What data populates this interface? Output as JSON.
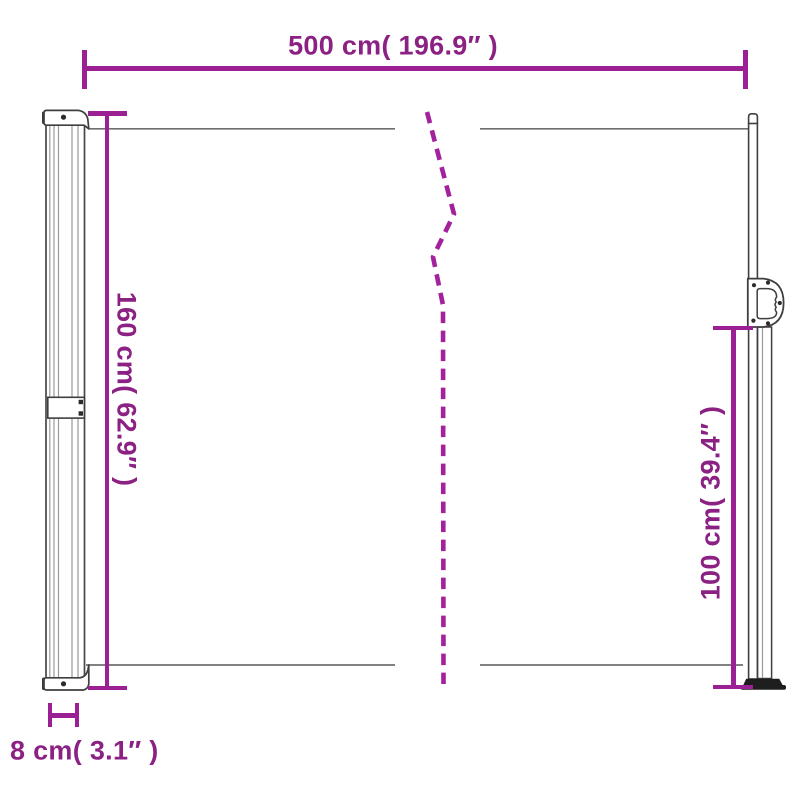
{
  "diagram": {
    "colors": {
      "dimension_line": "#9b2093",
      "dimension_text": "#8c2184",
      "break_line": "#a3219c",
      "outline": "#3f3f3f",
      "fabric_line": "#6f6f6f",
      "background": "#ffffff"
    },
    "dimensions": {
      "total_width": {
        "label": "500 cm( 196.9″ )",
        "value_cm": 500,
        "value_inch": 196.9
      },
      "left_height": {
        "label": "160 cm( 62.9″ )",
        "value_cm": 160,
        "value_inch": 62.9
      },
      "right_height": {
        "label": "100 cm( 39.4″ )",
        "value_cm": 100,
        "value_inch": 39.4
      },
      "post_depth": {
        "label": "8 cm( 3.1″ )",
        "value_cm": 8,
        "value_inch": 3.1
      }
    }
  }
}
